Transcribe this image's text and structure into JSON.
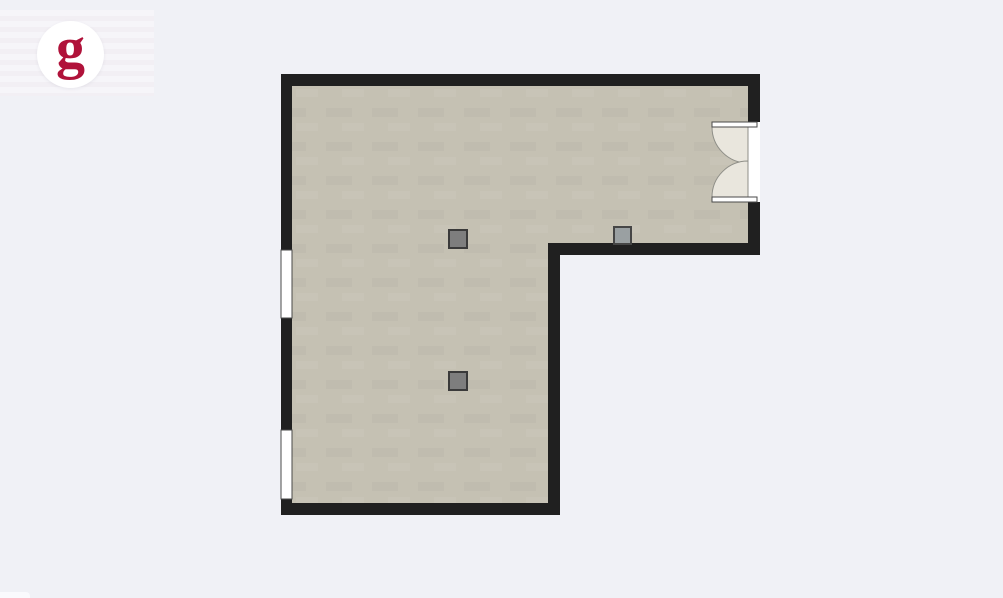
{
  "page": {
    "background_color": "#f0f1f6"
  },
  "logo": {
    "glyph": "g",
    "glyph_color": "#b0123a",
    "circle_color": "#ffffff"
  },
  "floorplan": {
    "colors": {
      "wall": "#202020",
      "floor": "#c5c1b3",
      "opening": "#ffffff",
      "frame_stroke": "#4a4a4a",
      "door_swing": "#e9e6dd",
      "swing_stroke": "#8f8f88"
    },
    "outer_polygon": [
      [
        281,
        74
      ],
      [
        760,
        74
      ],
      [
        760,
        255
      ],
      [
        560,
        255
      ],
      [
        560,
        515
      ],
      [
        281,
        515
      ]
    ],
    "inner_polygon": [
      [
        292,
        86
      ],
      [
        748,
        86
      ],
      [
        748,
        243
      ],
      [
        548,
        243
      ],
      [
        548,
        503
      ],
      [
        292,
        503
      ]
    ],
    "windows": [
      {
        "x": 281,
        "y": 250,
        "w": 11,
        "h": 68
      },
      {
        "x": 281,
        "y": 430,
        "w": 11,
        "h": 69
      }
    ],
    "door": {
      "type": "double-swing-inward",
      "opening": {
        "x": 740,
        "y": 122,
        "w": 20,
        "h": 80
      },
      "leaves": [
        {
          "x": 712,
          "y": 122,
          "w": 45,
          "h": 5
        },
        {
          "x": 712,
          "y": 197,
          "w": 45,
          "h": 5
        }
      ],
      "swings": [
        "M 712,127 A 36,36 0 0 0 748,163 L 748,127 Z",
        "M 712,197 A 36,36 0 0 1 748,161 L 748,197 Z"
      ]
    },
    "fixtures": [
      {
        "name": "column-fixture",
        "x": 449,
        "y": 230,
        "w": 18,
        "h": 18,
        "fill": "#7e7e7e",
        "stroke": "#3a3a3a"
      },
      {
        "name": "column-fixture",
        "x": 449,
        "y": 372,
        "w": 18,
        "h": 18,
        "fill": "#7e7e7e",
        "stroke": "#3a3a3a"
      },
      {
        "name": "wall-fixture",
        "x": 614,
        "y": 227,
        "w": 17,
        "h": 17,
        "fill": "#9aa0a2",
        "stroke": "#464646"
      }
    ]
  }
}
